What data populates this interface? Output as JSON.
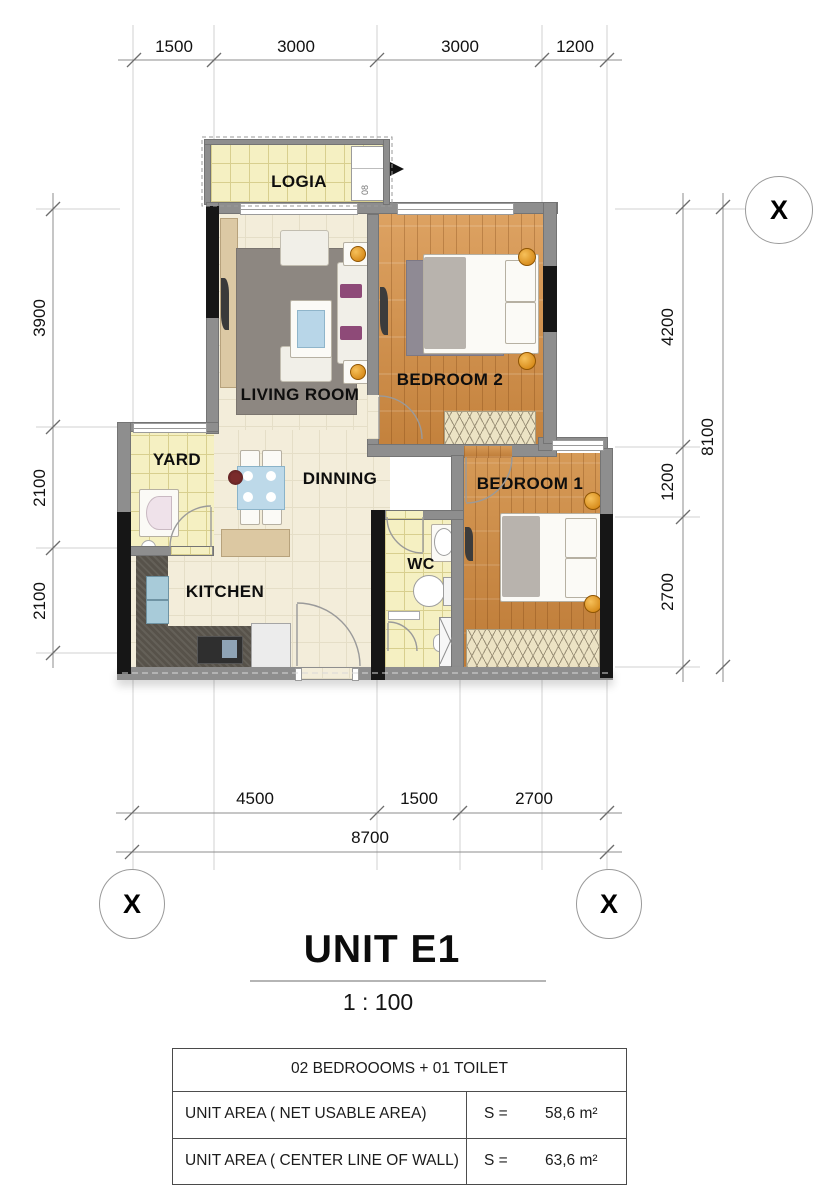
{
  "rooms": {
    "logia": "LOGIA",
    "living": "LIVING ROOM",
    "bedroom2": "BEDROOM 2",
    "yard": "YARD",
    "dinning": "DINNING",
    "kitchen": "KITCHEN",
    "wc": "WC",
    "bedroom1": "BEDROOM 1"
  },
  "plan": {
    "shaft_label": "08"
  },
  "dimensions": {
    "top": [
      "1500",
      "3000",
      "3000",
      "1200"
    ],
    "left": [
      "3900",
      "2100",
      "2100"
    ],
    "right": [
      "4200",
      "1200",
      "2700"
    ],
    "right_total": "8100",
    "bottom": [
      "4500",
      "1500",
      "2700"
    ],
    "bottom_total": "8700"
  },
  "markers": {
    "top_right": "X",
    "bottom_left": "X",
    "bottom_right": "X"
  },
  "title": {
    "name": "UNIT E1",
    "scale": "1 : 100"
  },
  "info_table": {
    "header": "02 BEDROOOMS + 01 TOILET",
    "rows": [
      {
        "label": "UNIT AREA ( NET USABLE AREA)",
        "prefix": "S =",
        "value": "58,6 m²"
      },
      {
        "label": "UNIT AREA ( CENTER LINE OF WALL)",
        "prefix": "S =",
        "value": "63,6 m²"
      }
    ]
  },
  "colors": {
    "wall": "#8e8e8e",
    "column": "#161616",
    "wood": "#d1944f",
    "tile_yellow": "#f5f0c2",
    "floor_cream": "#f3edda",
    "lamp_accent": "#e8960f",
    "table_blue": "#bdd9e9"
  }
}
